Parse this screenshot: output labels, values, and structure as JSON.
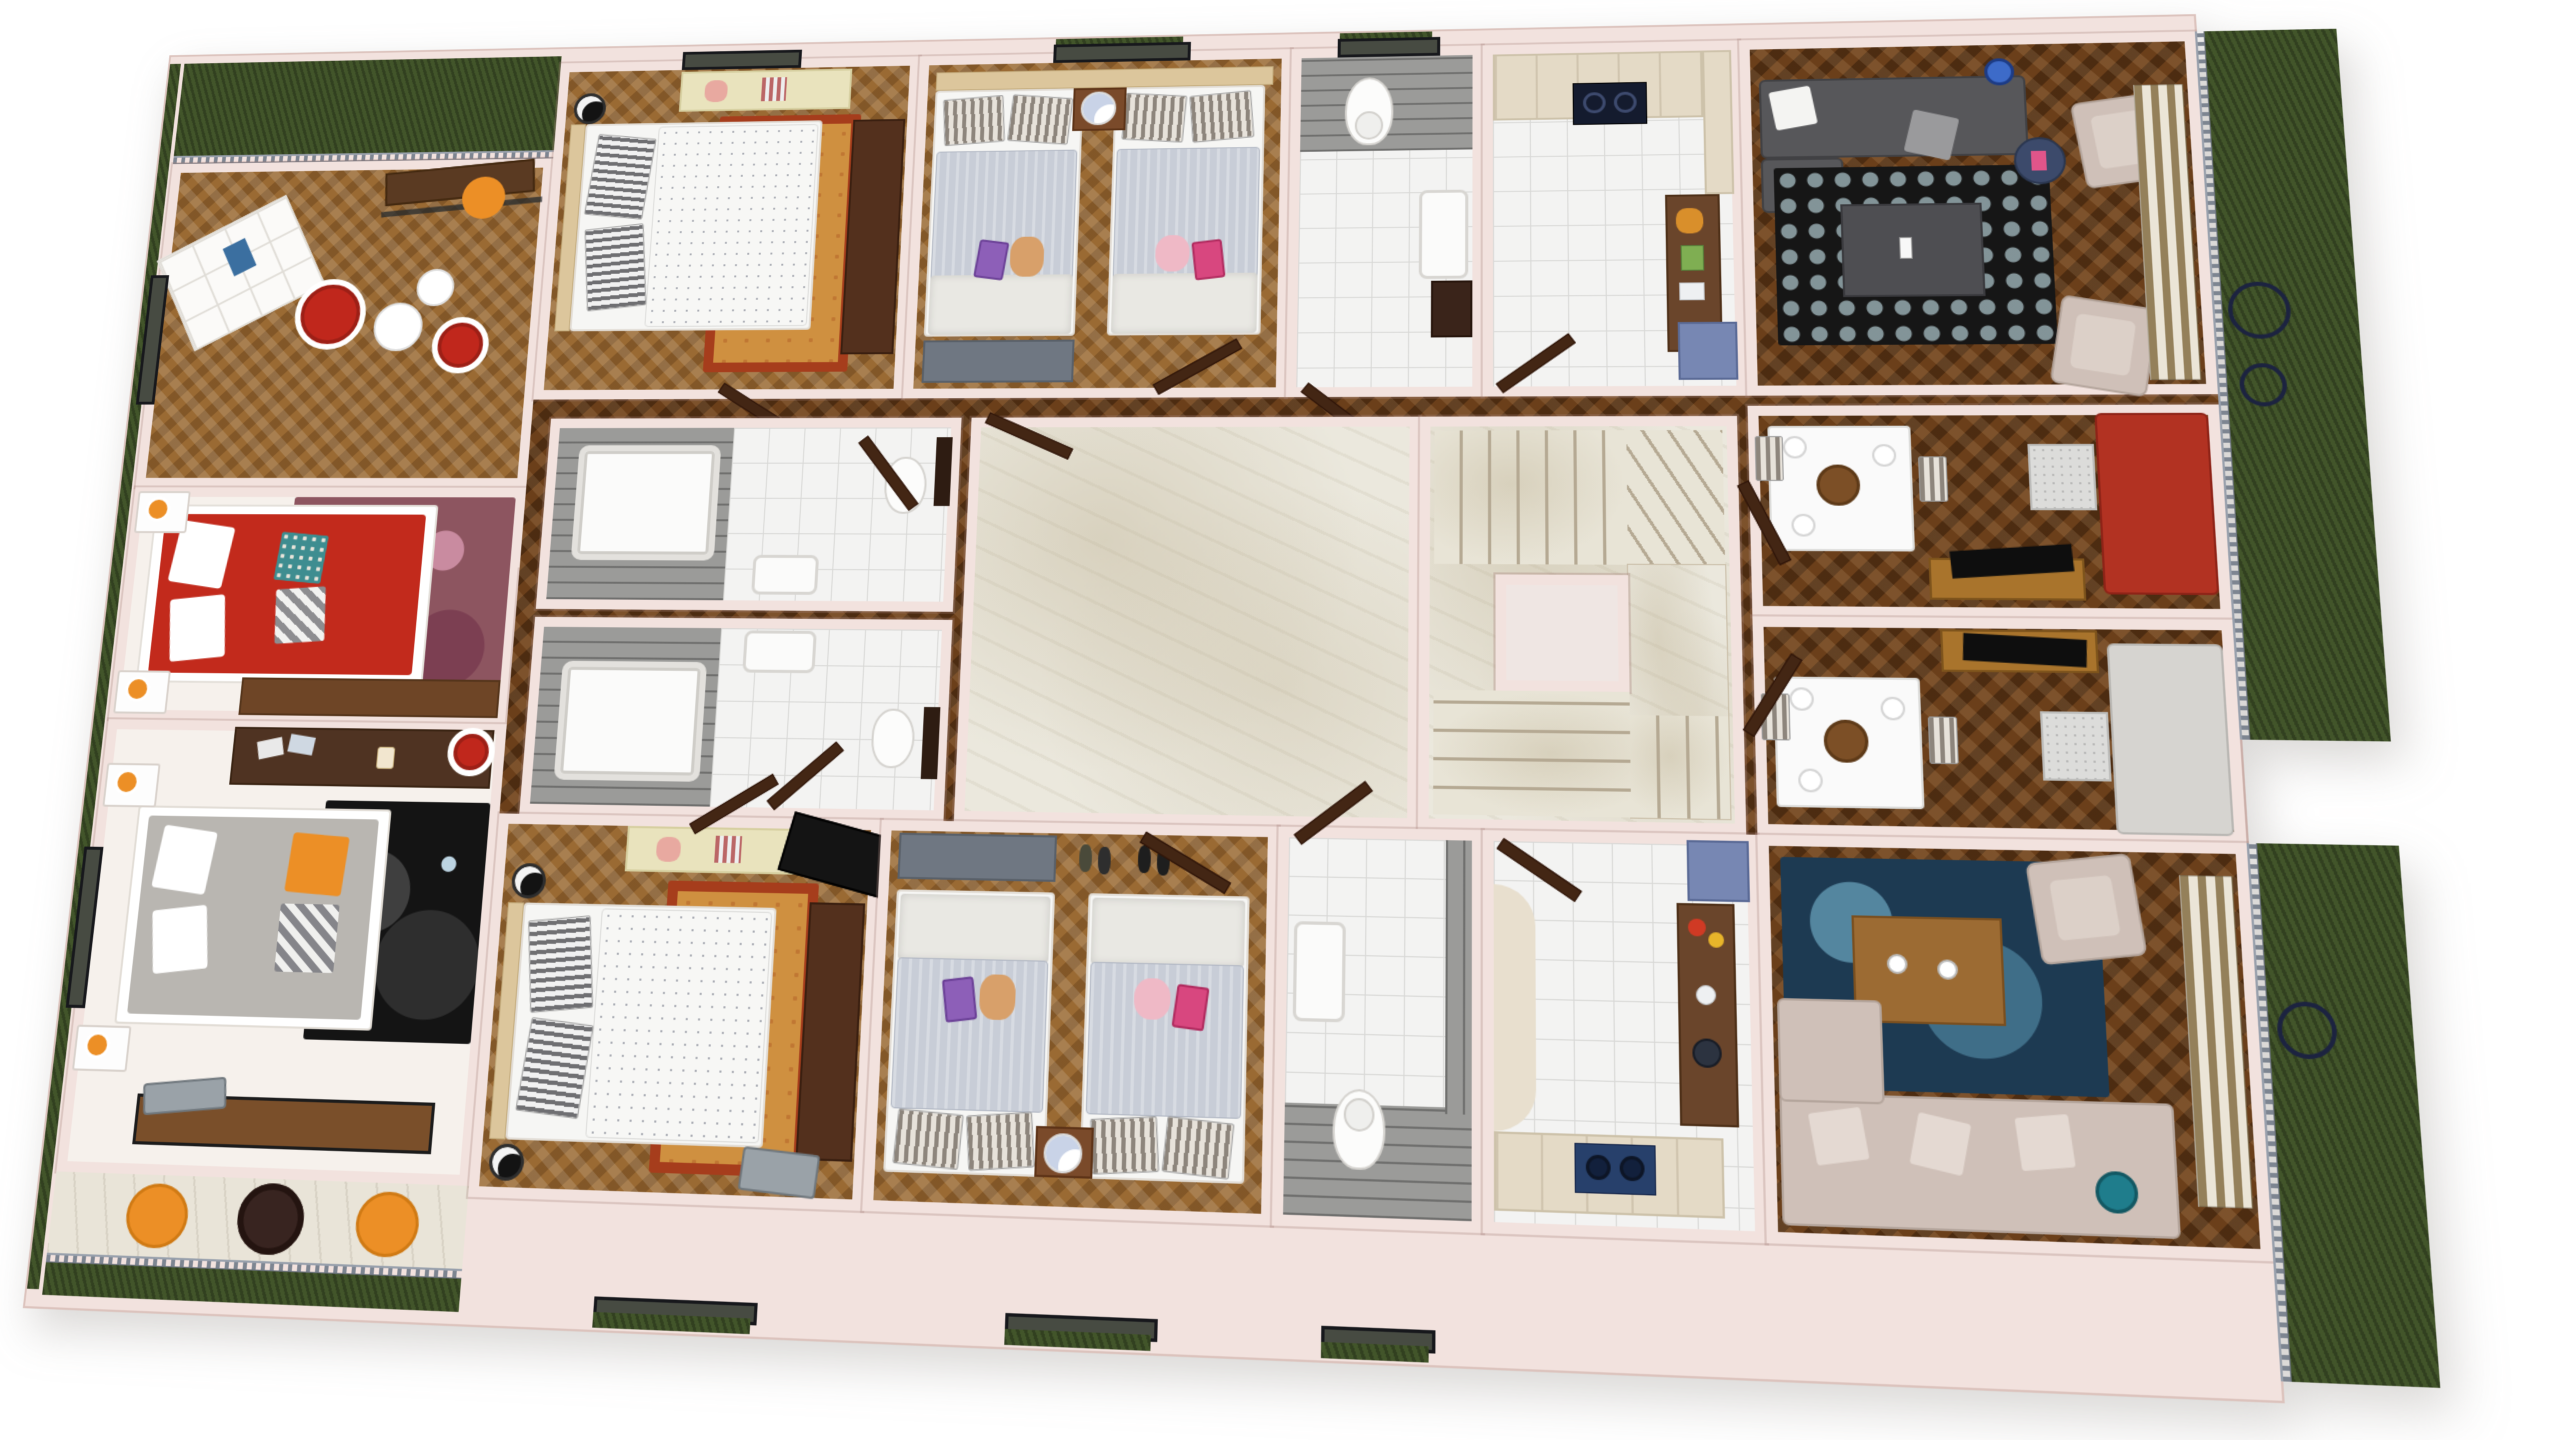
{
  "scene": {
    "title": "3D floor plan render — residential storey, top-down dollhouse view",
    "style": "photoreal 3D render, perspective top view, no visible text",
    "background": "#ffffff",
    "wings": "two mirrored apartment wings (north and south) around a central marble hall and staircase"
  },
  "palette": {
    "wall": "#f2e2de",
    "wall_edge": "#dcc3bd",
    "wood": "#9a6a33",
    "wood_dark": "#6b3f1a",
    "marble": "#ebe8dd",
    "tile": "#f3f3f2",
    "plank": "#9b9b99",
    "grass": "#42552a",
    "accent_red": "#c0271c",
    "accent_orange": "#ec8f26",
    "sofa_red": "#b23222",
    "sofa_grey": "#d6d4d0",
    "sofa_dark": "#57575a",
    "sofa_beige": "#cfc0b8",
    "rug_blue": "#1d3a52",
    "rug_black": "#161616",
    "rug_maroon": "#8d5560",
    "rug_gold": "#cf9040",
    "cabinet_blue": "#7787b3",
    "cabinet_cream": "#e4dac6",
    "island_wood": "#6a452b",
    "curtain_tan": "#94805a"
  },
  "rooms": {
    "garden_tl": {
      "name": "Roof garden strip (north-west) with railing"
    },
    "lounge": {
      "name": "Lounge / study with cube shelf, red egg chairs and balcony nook",
      "items": [
        "cube-shelf",
        "red-egg-chair",
        "red-egg-chair",
        "pedestal-table",
        "pedestal-table",
        "balcony-table",
        "orange-chair",
        "glass-balustrade"
      ]
    },
    "daybed_zone": {
      "name": "Sitting nook with red daybed and circle rug",
      "items": [
        "red-daybed",
        "white-cushions",
        "teal-pillow",
        "chevron-pillow",
        "maroon-circle-rug",
        "orange-lamp-nightstand",
        "orange-lamp-nightstand",
        "wood-bench"
      ]
    },
    "bedroom_left": {
      "name": "Bedroom (west wing) with grey bed and desk",
      "items": [
        "dark-desk",
        "photo-prints",
        "mug",
        "red-bowl-chair",
        "grey-double-bed",
        "orange-cushion",
        "chevron-throw",
        "black-circle-rug",
        "orange-lamp-nightstand",
        "orange-lamp-nightstand",
        "storage-bench",
        "suitcase",
        "plank-closet",
        "window"
      ]
    },
    "terrace": {
      "name": "Terrace with orange egg chairs and wicker table",
      "items": [
        "orange-egg-chair",
        "orange-egg-chair",
        "wicker-table",
        "railing",
        "grass"
      ]
    },
    "bedroom_n": {
      "name": "Double bedroom (north)",
      "items": [
        "double-bed",
        "striped-pillows",
        "black-bedside-lamp",
        "cream-bench",
        "clothes",
        "wardrobe",
        "persian-rug",
        "window",
        "door"
      ]
    },
    "twin_n": {
      "name": "Twin bedroom (north)",
      "items": [
        "single-bed",
        "single-bed",
        "shared-headboard",
        "nightstand",
        "white-ball-lamp",
        "grey-chest",
        "folded-clothes",
        "window",
        "door"
      ]
    },
    "wc_n": {
      "name": "WC (north) with plank feature wall",
      "items": [
        "toilet",
        "wall-basin",
        "dark-vanity",
        "window",
        "door"
      ]
    },
    "kitchen_n": {
      "name": "Kitchen (north)",
      "items": [
        "cream-cabinets",
        "black-cooktop",
        "tall-cabinet",
        "island-counter",
        "blue-sideboard",
        "marble-worktop",
        "door"
      ]
    },
    "living_ne": {
      "name": "Living room (north-east)",
      "items": [
        "dark-grey-corner-sofa",
        "white-pillows",
        "checker-rug",
        "grey-coffee-table",
        "phone",
        "beige-armchair",
        "beige-armchair",
        "blue-side-table",
        "blue-floor-lamp",
        "striped-curtains"
      ]
    },
    "bath_a": {
      "name": "Bathroom A (central west)",
      "items": [
        "bathtub",
        "plank-shower-wall",
        "wall-basin",
        "toilet",
        "dark-shelf",
        "door"
      ]
    },
    "bath_b": {
      "name": "Bathroom B (central west)",
      "items": [
        "bathtub",
        "plank-shower-wall",
        "wall-basin",
        "toilet",
        "dark-shelf",
        "door"
      ]
    },
    "hall": {
      "name": "Central marble hall"
    },
    "stairs": {
      "name": "Marble staircase with landing and stairwell void",
      "items": [
        "upper-flight",
        "winder-steps",
        "landing",
        "void",
        "lower-flight"
      ]
    },
    "family_a": {
      "name": "Family room A with red sofa",
      "items": [
        "white-dining-table",
        "plates",
        "fruit-bowl",
        "grey-chairs",
        "tv-console",
        "tv",
        "red-sofa",
        "marble-side-table"
      ]
    },
    "family_b": {
      "name": "Family room B with grey sofa",
      "items": [
        "white-dining-table",
        "plates",
        "fruit-bowl",
        "grey-chairs",
        "tv-console",
        "tv",
        "grey-sofa",
        "marble-side-table"
      ]
    },
    "bedroom_s": {
      "name": "Double bedroom (south)",
      "items": [
        "double-bed",
        "striped-pillows",
        "black-bedside-lamp",
        "black-bedside-lamp",
        "cream-bench",
        "clothes",
        "wardrobe",
        "persian-rug",
        "tv-panel",
        "suitcase",
        "window",
        "door"
      ]
    },
    "twin_s": {
      "name": "Twin bedroom (south)",
      "items": [
        "single-bed",
        "single-bed",
        "nightstand",
        "white-ball-lamp",
        "grey-chest",
        "shoes",
        "folded-clothes",
        "window",
        "door"
      ]
    },
    "wc_s": {
      "name": "WC (south)",
      "items": [
        "toilet",
        "wall-basin",
        "plank-wall",
        "window",
        "door"
      ]
    },
    "kitchen_s": {
      "name": "Kitchen (south)",
      "items": [
        "cream-cabinets",
        "blue-cooktop",
        "island-counter",
        "fruit",
        "blender",
        "blue-sideboard",
        "marble-worktop",
        "door"
      ]
    },
    "living_se": {
      "name": "Living room (south-east)",
      "items": [
        "beige-corner-sofa",
        "cushions",
        "blue-circle-rug",
        "wood-coffee-table",
        "cups",
        "beige-armchair",
        "striped-curtains",
        "teal-floor-lamp"
      ]
    },
    "garden_e": {
      "name": "Roof garden strip (east) with railing and bistro set"
    },
    "garden_se": {
      "name": "Roof garden strip (south-east) with railing"
    },
    "garden_sw": {
      "name": "Grass strip (south-west)"
    }
  }
}
